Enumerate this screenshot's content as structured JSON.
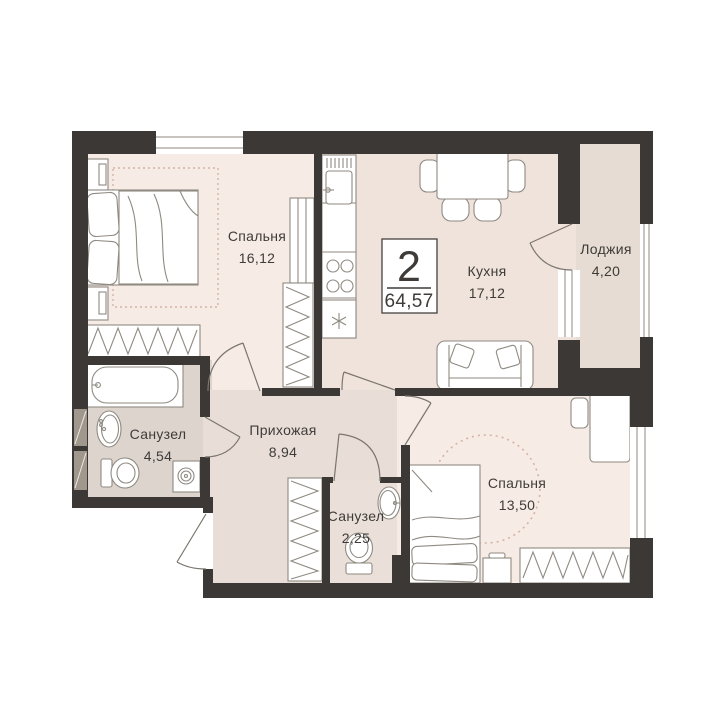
{
  "plan": {
    "badge": {
      "rooms_count": "2",
      "total_area": "64,57"
    },
    "rooms": [
      {
        "id": "bedroom-1",
        "name": "Спальня",
        "area": "16,12"
      },
      {
        "id": "kitchen",
        "name": "Кухня",
        "area": "17,12"
      },
      {
        "id": "loggia",
        "name": "Лоджия",
        "area": "4,20"
      },
      {
        "id": "bathroom-1",
        "name": "Санузел",
        "area": "4,54"
      },
      {
        "id": "hallway",
        "name": "Прихожая",
        "area": "8,94"
      },
      {
        "id": "bathroom-2",
        "name": "Санузел",
        "area": "2,25"
      },
      {
        "id": "bedroom-2",
        "name": "Спальня",
        "area": "13,50"
      }
    ],
    "colors": {
      "wall": "#3b3835",
      "text": "#3e3b38",
      "door": "#7b766f",
      "furniture": "#8f8a82",
      "window_frame": "#8f8a82",
      "accent_dashed": "#d4b3a6",
      "badge_border": "#44413d",
      "vent_shaft": "#a0978d",
      "room_fills": {
        "bedroom_1": "#f7ebe6",
        "kitchen": "#f0e3dc",
        "loggia": "#e6dcd3",
        "bathroom_1": "#ddd4ce",
        "hallway": "#e8ded7",
        "bathroom_2": "#eae0d9",
        "bedroom_2": "#f7ebe6"
      }
    }
  }
}
